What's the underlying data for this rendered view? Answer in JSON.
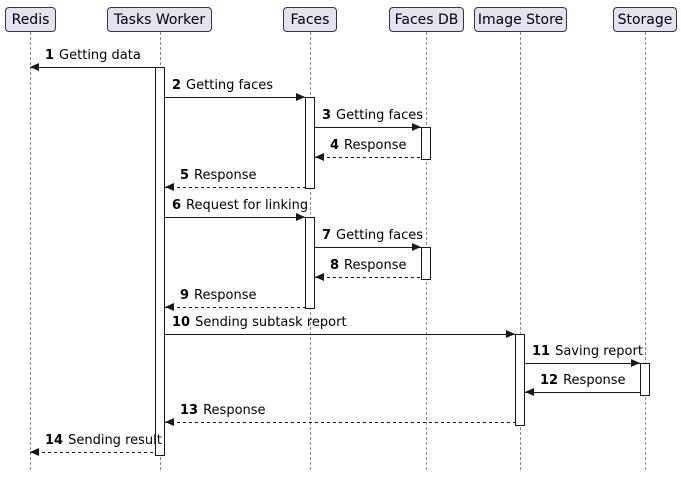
{
  "colors": {
    "background": "#FFFFFF",
    "participant_fill": "#E2E2F0",
    "participant_border": "#33334A",
    "lifeline": "#8A8A8A",
    "message_line": "#181818",
    "activation_fill": "#FFFFFF",
    "activation_border": "#181818",
    "text": "#000000"
  },
  "diagram": {
    "type": "uml-sequence-diagram",
    "participants": [
      {
        "label": "Redis",
        "center_x": 30,
        "box_left": 5,
        "box_width": 51
      },
      {
        "label": "Tasks Worker",
        "center_x": 160,
        "box_left": 107,
        "box_width": 105
      },
      {
        "label": "Faces",
        "center_x": 310,
        "box_left": 283,
        "box_width": 54
      },
      {
        "label": "Faces DB",
        "center_x": 426,
        "box_left": 389,
        "box_width": 75
      },
      {
        "label": "Image Store",
        "center_x": 520,
        "box_left": 474,
        "box_width": 93
      },
      {
        "label": "Storage",
        "center_x": 645,
        "box_left": 613,
        "box_width": 64
      }
    ],
    "lifeline_top": 32,
    "lifeline_bottom": 470,
    "activations": [
      {
        "participant": "Tasks Worker",
        "x": 155,
        "top": 67,
        "bottom": 456
      },
      {
        "participant": "Faces",
        "x": 305,
        "top": 97,
        "bottom": 189
      },
      {
        "participant": "Faces",
        "x": 305,
        "top": 217,
        "bottom": 309
      },
      {
        "participant": "Faces DB",
        "x": 421,
        "top": 127,
        "bottom": 160
      },
      {
        "participant": "Faces DB",
        "x": 421,
        "top": 247,
        "bottom": 280
      },
      {
        "participant": "Image Store",
        "x": 515,
        "top": 334,
        "bottom": 426
      },
      {
        "participant": "Storage",
        "x": 640,
        "top": 363,
        "bottom": 396
      }
    ],
    "messages": [
      {
        "num": "1",
        "text": "Getting data",
        "from": "Tasks Worker",
        "to": "Redis",
        "y": 67,
        "x1": 155,
        "x2": 30,
        "dir": "left",
        "line": "solid"
      },
      {
        "num": "2",
        "text": "Getting faces",
        "from": "Tasks Worker",
        "to": "Faces",
        "y": 97,
        "x1": 165,
        "x2": 305,
        "dir": "right",
        "line": "solid"
      },
      {
        "num": "3",
        "text": "Getting faces",
        "from": "Faces",
        "to": "Faces DB",
        "y": 127,
        "x1": 315,
        "x2": 421,
        "dir": "right",
        "line": "solid"
      },
      {
        "num": "4",
        "text": "Response",
        "from": "Faces DB",
        "to": "Faces",
        "y": 157,
        "x1": 421,
        "x2": 315,
        "dir": "left",
        "line": "dashed"
      },
      {
        "num": "5",
        "text": "Response",
        "from": "Faces",
        "to": "Tasks Worker",
        "y": 187,
        "x1": 305,
        "x2": 165,
        "dir": "left",
        "line": "dashed"
      },
      {
        "num": "6",
        "text": "Request for linking",
        "from": "Tasks Worker",
        "to": "Faces",
        "y": 217,
        "x1": 165,
        "x2": 305,
        "dir": "right",
        "line": "solid"
      },
      {
        "num": "7",
        "text": "Getting faces",
        "from": "Faces",
        "to": "Faces DB",
        "y": 247,
        "x1": 315,
        "x2": 421,
        "dir": "right",
        "line": "solid"
      },
      {
        "num": "8",
        "text": "Response",
        "from": "Faces DB",
        "to": "Faces",
        "y": 277,
        "x1": 421,
        "x2": 315,
        "dir": "left",
        "line": "dashed"
      },
      {
        "num": "9",
        "text": "Response",
        "from": "Faces",
        "to": "Tasks Worker",
        "y": 307,
        "x1": 305,
        "x2": 165,
        "dir": "left",
        "line": "dashed"
      },
      {
        "num": "10",
        "text": "Sending subtask report",
        "from": "Tasks Worker",
        "to": "Image Store",
        "y": 334,
        "x1": 165,
        "x2": 515,
        "dir": "right",
        "line": "solid"
      },
      {
        "num": "11",
        "text": "Saving report",
        "from": "Image Store",
        "to": "Storage",
        "y": 363,
        "x1": 525,
        "x2": 640,
        "dir": "right",
        "line": "solid"
      },
      {
        "num": "12",
        "text": "Response",
        "from": "Storage",
        "to": "Image Store",
        "y": 392,
        "x1": 640,
        "x2": 525,
        "dir": "left",
        "line": "solid"
      },
      {
        "num": "13",
        "text": "Response",
        "from": "Image Store",
        "to": "Tasks Worker",
        "y": 422,
        "x1": 515,
        "x2": 165,
        "dir": "left",
        "line": "dashed"
      },
      {
        "num": "14",
        "text": "Sending result",
        "from": "Tasks Worker",
        "to": "Redis",
        "y": 452,
        "x1": 155,
        "x2": 30,
        "dir": "left",
        "line": "dashed"
      }
    ]
  }
}
